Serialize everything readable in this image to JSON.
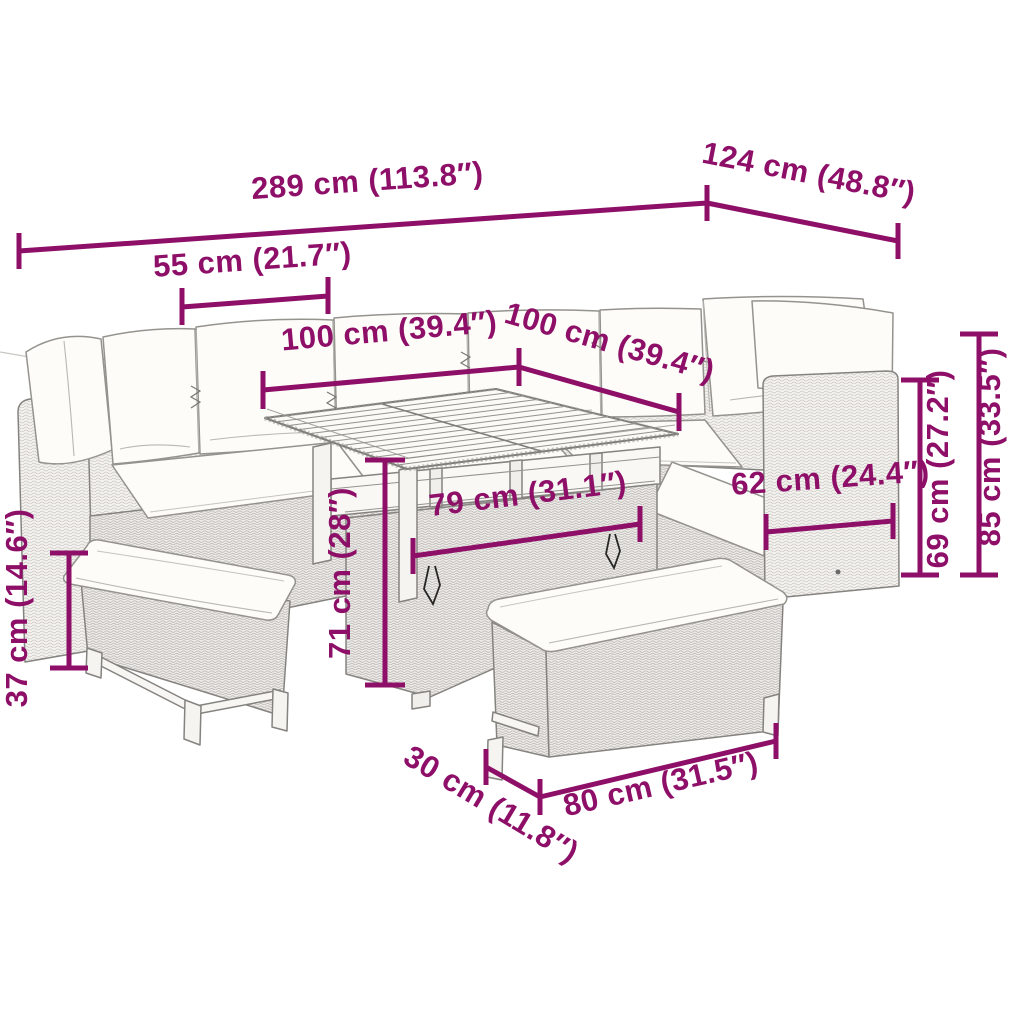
{
  "colors": {
    "dimension_accent": "#8E0F68",
    "drawing_line": "#85837f",
    "cushion_fill": "#fdfcf8",
    "background": "#ffffff"
  },
  "dimensions": {
    "d289": "289 cm (113.8″)",
    "d124": "124 cm (48.8″)",
    "d55": "55 cm (21.7″)",
    "d100a": "100 cm (39.4″)",
    "d100b": "100 cm (39.4″)",
    "d79": "79 cm (31.1″)",
    "d71": "71 cm (28″)",
    "d62": "62 cm (24.4″)",
    "d69": "69 cm (27.2″)",
    "d85": "85 cm (33.5″)",
    "d37": "37 cm (14.6″)",
    "d30": "30 cm (11.8″)",
    "d80": "80 cm (31.5″)"
  }
}
